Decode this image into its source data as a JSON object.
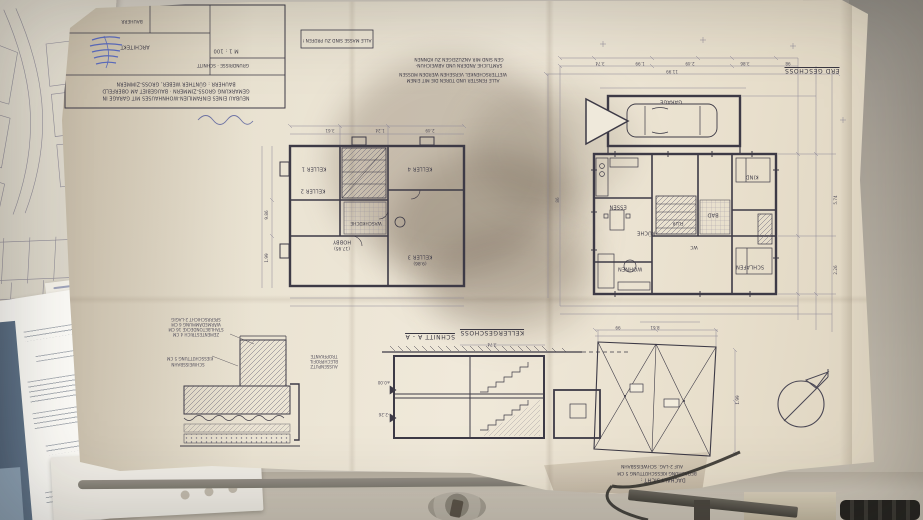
{
  "colors": {
    "paper": "#ece5d5",
    "ink_line": "#3d3a46",
    "stamp_blue": "#3b53c2",
    "desk": "#cdc6bb"
  },
  "blueprint": {
    "title_block": {
      "line1": "NEUBAU EINES EINFAMILIEN-WOHNHAUSES MIT GARAGE IN",
      "line2": "GEMARKUNG GROSS-ZIMMERN · BAUGEBIET AM OBERFELD",
      "line3": "BAUHERR : GÜNTHER WEBER, GROSS-ZIMMERN",
      "architect_label": "ARCHITEKT",
      "bauherr_label": "BAUHERR",
      "scale": "M 1 : 100",
      "caption": "GRUNDRISSE · SCHNITT"
    },
    "notes": {
      "box": "ALLE MASSE SIND ZU PRÜFEN !",
      "a1": "SÄMTLICHE ÄNDERN UND ABWEICHUN-",
      "a2": "GEN SIND MIR ANZUZEIGEN ZU KÖNNEN",
      "b1": "ALLE FENSTER UND TÜREN DIE MIT EINEM",
      "b2": "WETTERSCHENKEL VERSEHEN WERDEN MÜSSEN"
    },
    "captions": {
      "erdgeschoss": "ERD GESCHOSS",
      "kellergeschoss": "KELLERGESCHOSS",
      "schnitt": "SCHNITT A - A",
      "dach1": "DACHAUFSICHT :",
      "dach2": "BEDACHUNG KIESSCHÜTTUNG 5 CM",
      "dach3": "AUF 2-LAG. SCHWEISSBAHN"
    },
    "rooms_eg": {
      "garage": "GARAGE",
      "wohnen": "WOHNEN",
      "essen": "ESSEN",
      "kueche": "KÜCHE",
      "schlafen": "SCHLAFEN",
      "kind": "KIND",
      "bad": "BAD",
      "wc": "WC",
      "flur": "FLUR"
    },
    "rooms_kg": {
      "k1": "KELLER 1",
      "k2": "KELLER 2",
      "k3": "KELLER 3",
      "k3_area": "(9.86)",
      "k4": "KELLER 4",
      "wasch": "WASCHKÜCHE",
      "hobby": "HOBBY",
      "hobby_area": "(17.95)"
    },
    "detail_layers": {
      "l1": "ZEMENTESTRICH 4 CM",
      "l2": "STAHLBETONDECKE 16 CM",
      "l3": "WÄRMEDÄMMUNG 6 CM",
      "l4": "SPERRSCHICHT 2-LAGIG",
      "l5": "KIESSCHÜTTUNG 5 CM",
      "l6": "SCHWEISSBAHN",
      "l7": "TROPFKANTE",
      "l8": "BLECHPROFIL",
      "l9": "AUSSENPUTZ"
    },
    "section_levels": {
      "l0": "±0.00",
      "l1": "-2.26"
    },
    "dims": {
      "d1": "3.74",
      "d2": "1.99",
      "d3": "2.49",
      "d4": "3.86",
      "d5": "98",
      "d6": "11.99",
      "d7": "5.74",
      "d8": "86",
      "d9": "2.26",
      "d10": "3.61",
      "d11": "1.24",
      "d12": "9.86",
      "d13": "1.99",
      "d14": "2.49",
      "d15": "3.74",
      "d16": "8.61",
      "d17": "99",
      "d18": "1.99"
    }
  }
}
